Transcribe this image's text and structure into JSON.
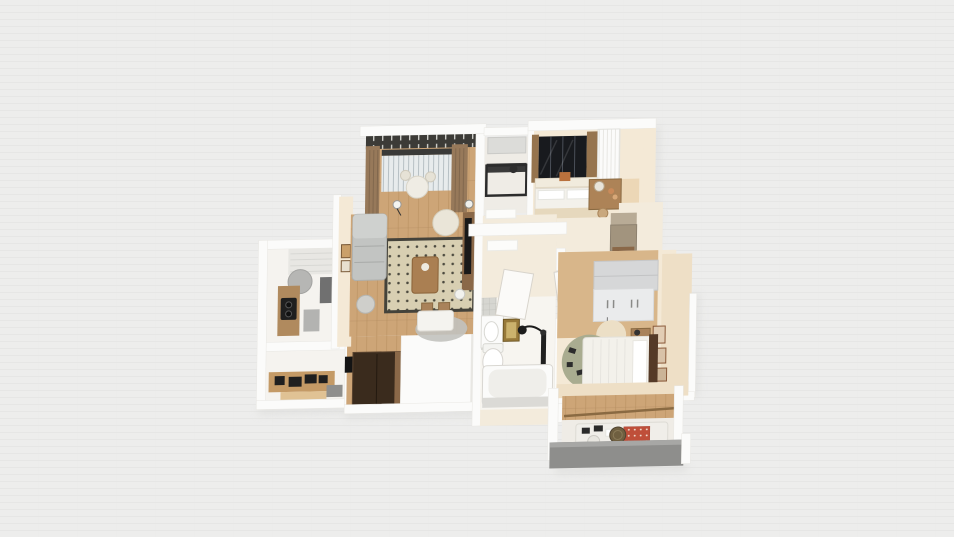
{
  "scene": {
    "description": "3D top-down render of a furnished apartment floor plan on a plain light backdrop",
    "style": "isometric dollhouse render, slightly rotated",
    "background_color": "#ededec"
  },
  "colors": {
    "bg": "#ededec",
    "bg_line": "#e2e2e0",
    "shadow": "#d9d9d7",
    "wall": "#fbfbfa",
    "wall_shade": "#e8e7e3",
    "cream": "#f4e9d6",
    "cream_dark": "#eedfc6",
    "hall_floor": "#f3ebdc",
    "bath_floor": "#f7f5f0",
    "kitchen_floor": "#f5f3ef",
    "pale_floor": "#efece6",
    "wood": "#cda577",
    "wood_dark": "#b08a5e",
    "wood_mid": "#c49a66",
    "wood_light": "#e0c294",
    "wood_warm": "#d8b68a",
    "plank_line": "#b28a5c",
    "espresso": "#3a2b1d",
    "espresso_edge": "#8a6848",
    "rug_field": "#d8cfb2",
    "rug_dot": "#4c4a3f",
    "rug_border": "#44423a",
    "sofa": "#c2c4c2",
    "sofa_light": "#cfd1cf",
    "armchair": "#eae5d8",
    "chair_gray": "#cfcfcb",
    "curtain": "#97795a",
    "valance": "#3c3b37",
    "glass": "#e7ebec",
    "mullion": "#b7c0c4",
    "win_black": "#181a1e",
    "frame_wood": "#96744e",
    "bed_beige": "#e6d8bd",
    "linen": "#f3f1eb",
    "pillow": "#ffffff",
    "bed_rug": "#eadfc9",
    "sage": "#a9ac90",
    "headboard": "#553a27",
    "taupe_top": "#b8ab96",
    "taupe": "#a2947e",
    "steel": "#2c2c2c",
    "appliance": "#1f1f1f",
    "gold": "#97793a",
    "gold_light": "#cbb26d",
    "porcelain": "#fbfbfa",
    "tub_inner": "#efeeea",
    "tub_panel": "#dbdad6",
    "fixture_edge": "#d8d5d0",
    "door": "#fbfaf8",
    "door_edge": "#d8d4cc",
    "balcony_gray": "#8e8e8c",
    "balcony_gray_light": "#a7a7a5",
    "wardrobe_top": "#d6d7d8",
    "wardrobe_front": "#eaebec",
    "handle": "#8a8a88",
    "quilt_red": "#bf4f3a",
    "tile_base": "#d6d6d1",
    "tile_line": "#bdbdb8",
    "mat_gray": "#b3b3b1",
    "mat_dark": "#8f8f8d",
    "counter_dark": "#707070",
    "vent_gray": "#b6b6b4"
  },
  "rooms": [
    {
      "id": "living-room",
      "label": "Living room",
      "furniture": [
        "gray sofa",
        "dotted rug",
        "wood coffee table",
        "cream armchair",
        "tv console",
        "floor lamps",
        "dining table with two chairs",
        "gray round rug",
        "robot vacuum",
        "wall frames"
      ]
    },
    {
      "id": "balcony-lounge",
      "label": "Living room balcony",
      "furniture": [
        "brown curtains",
        "slatted valance",
        "glazed wall with blinds",
        "bistro table",
        "two chairs"
      ]
    },
    {
      "id": "kitchen",
      "label": "Kitchen",
      "furniture": [
        "shelf unit",
        "range hood",
        "wood counter with black cooktop",
        "dark counter",
        "coffee bar with black appliances",
        "gray mats"
      ]
    },
    {
      "id": "utility-balcony",
      "label": "Utility balcony",
      "furniture": [
        "black metal desk",
        "plant"
      ]
    },
    {
      "id": "bedroom-primary",
      "label": "Bedroom with dark picture window",
      "furniture": [
        "black framed window",
        "window bench",
        "orange cushion",
        "double bed with beige cover",
        "beige rug",
        "wood vanity desk",
        "white slatted wardrobe"
      ]
    },
    {
      "id": "hallway",
      "label": "Hallway",
      "furniture": [
        "white runner mats",
        "white doors"
      ]
    },
    {
      "id": "bathroom",
      "label": "Bathroom",
      "furniture": [
        "mosaic tile strip",
        "vanity sink",
        "gold framed art",
        "black wall lamp",
        "toilet",
        "bathtub",
        "shower column"
      ]
    },
    {
      "id": "bedroom-second",
      "label": "Bedroom with wardrobe",
      "furniture": [
        "gray wardrobe",
        "pendant lamp",
        "cream round rug",
        "nightstand",
        "wall frames",
        "bed with white linens",
        "sage green round rug",
        "dark wood headboard",
        "taupe sideboard"
      ]
    },
    {
      "id": "kids-room",
      "label": "Small bedroom",
      "furniture": [
        "daybed",
        "red patterned quilt",
        "round side table",
        "small chair",
        "curtain rod"
      ]
    },
    {
      "id": "entry",
      "label": "Entry",
      "furniture": [
        "espresso cabinet"
      ]
    },
    {
      "id": "south-balcony",
      "label": "South balcony",
      "furniture": [
        "gray concrete slab"
      ]
    }
  ]
}
